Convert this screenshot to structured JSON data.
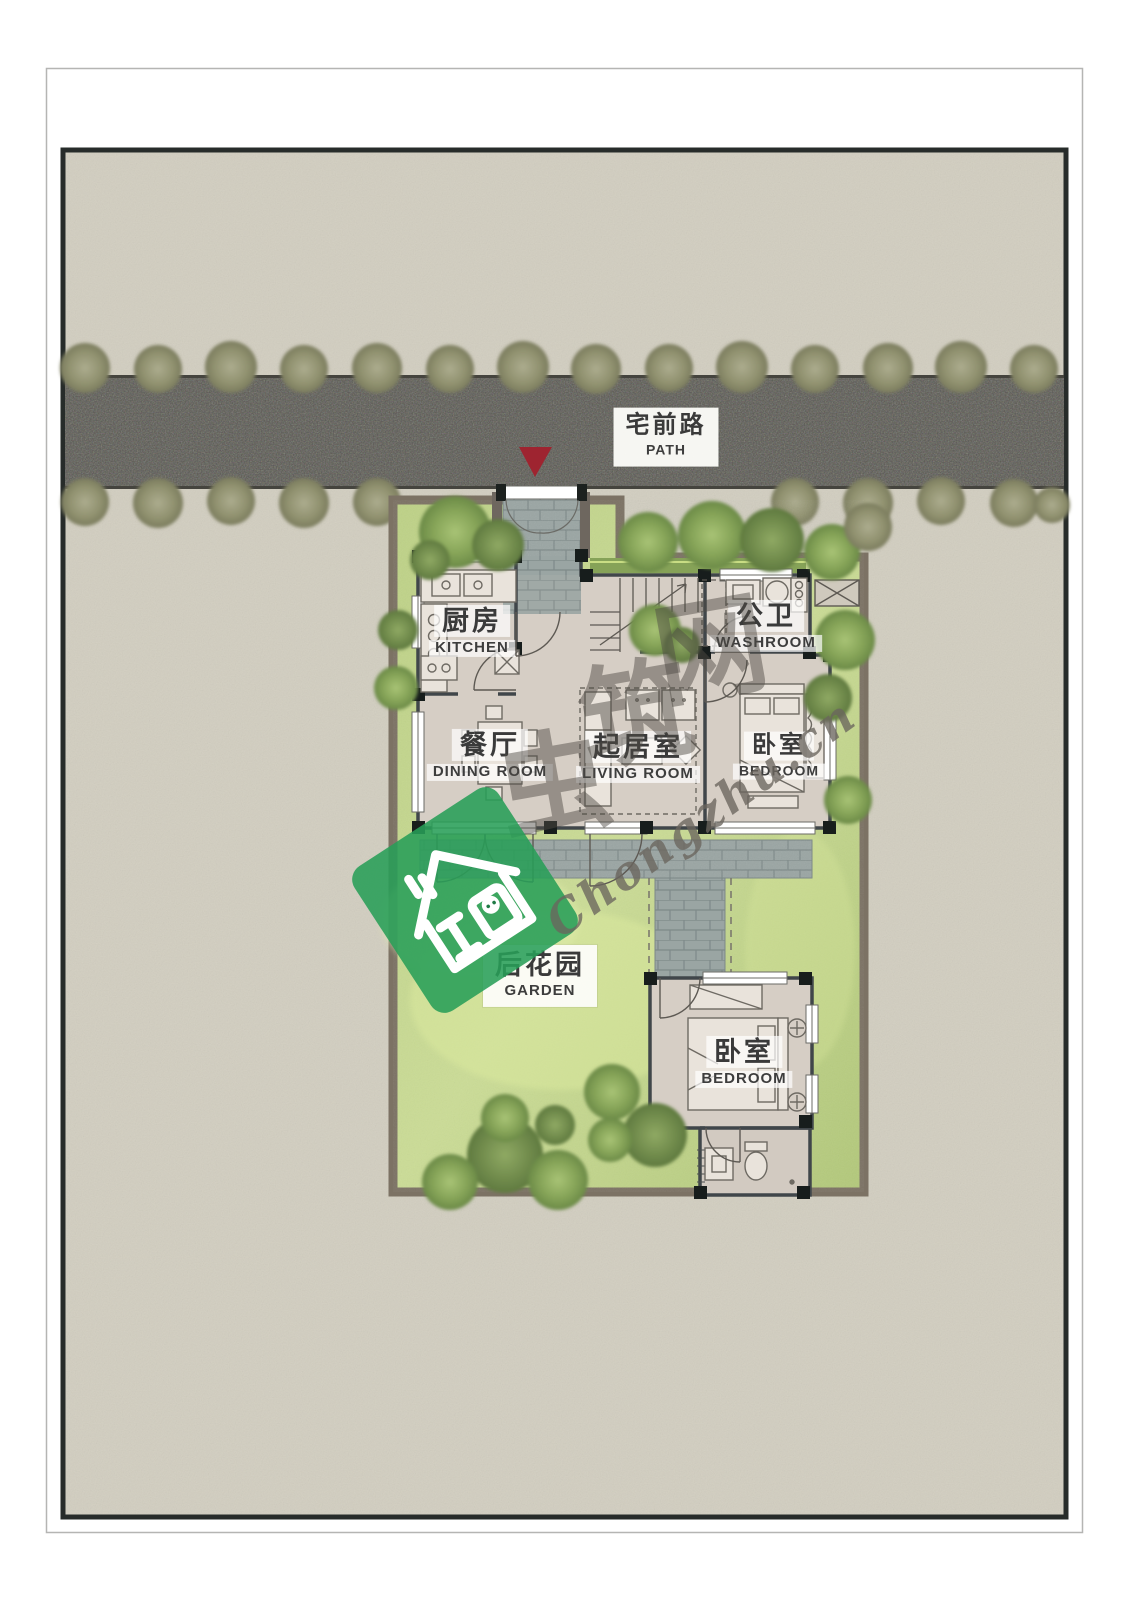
{
  "site": {
    "road": {
      "label_zh": "宅前路",
      "label_en": "PATH"
    },
    "garden": {
      "label_zh": "后花园",
      "label_en": "GARDEN"
    },
    "rooms": [
      {
        "key": "kitchen",
        "zh": "厨房",
        "en": "KITCHEN"
      },
      {
        "key": "washroom",
        "zh": "公卫",
        "en": "WASHROOM"
      },
      {
        "key": "dining-room",
        "zh": "餐厅",
        "en": "DINING ROOM"
      },
      {
        "key": "living-room",
        "zh": "起居室",
        "en": "LIVING ROOM"
      },
      {
        "key": "bedroom-upper",
        "zh": "卧室",
        "en": "BEDROOM"
      },
      {
        "key": "bedroom-lower",
        "zh": "卧室",
        "en": "BEDROOM"
      }
    ]
  },
  "watermark": {
    "brand_text": "Chongzhu.cn",
    "brand_zh": "虫筑网",
    "chars": [
      "虫",
      "筑",
      "网"
    ]
  },
  "colors": {
    "page_bg": "#ffffff",
    "site_ground": "#d2cec0",
    "road": "#56554e",
    "roadside_tree": "#8f9070",
    "grass": "#c3d68c",
    "garden_tree": "#85a457",
    "plot_border": "#7c7264",
    "house_floor": "#d6cec5",
    "wall": "#40464a",
    "paving": "#9aa5a3",
    "entrance_arrow": "#9e2430",
    "watermark_green": "#289e58",
    "label_text": "#3a3a3a"
  }
}
